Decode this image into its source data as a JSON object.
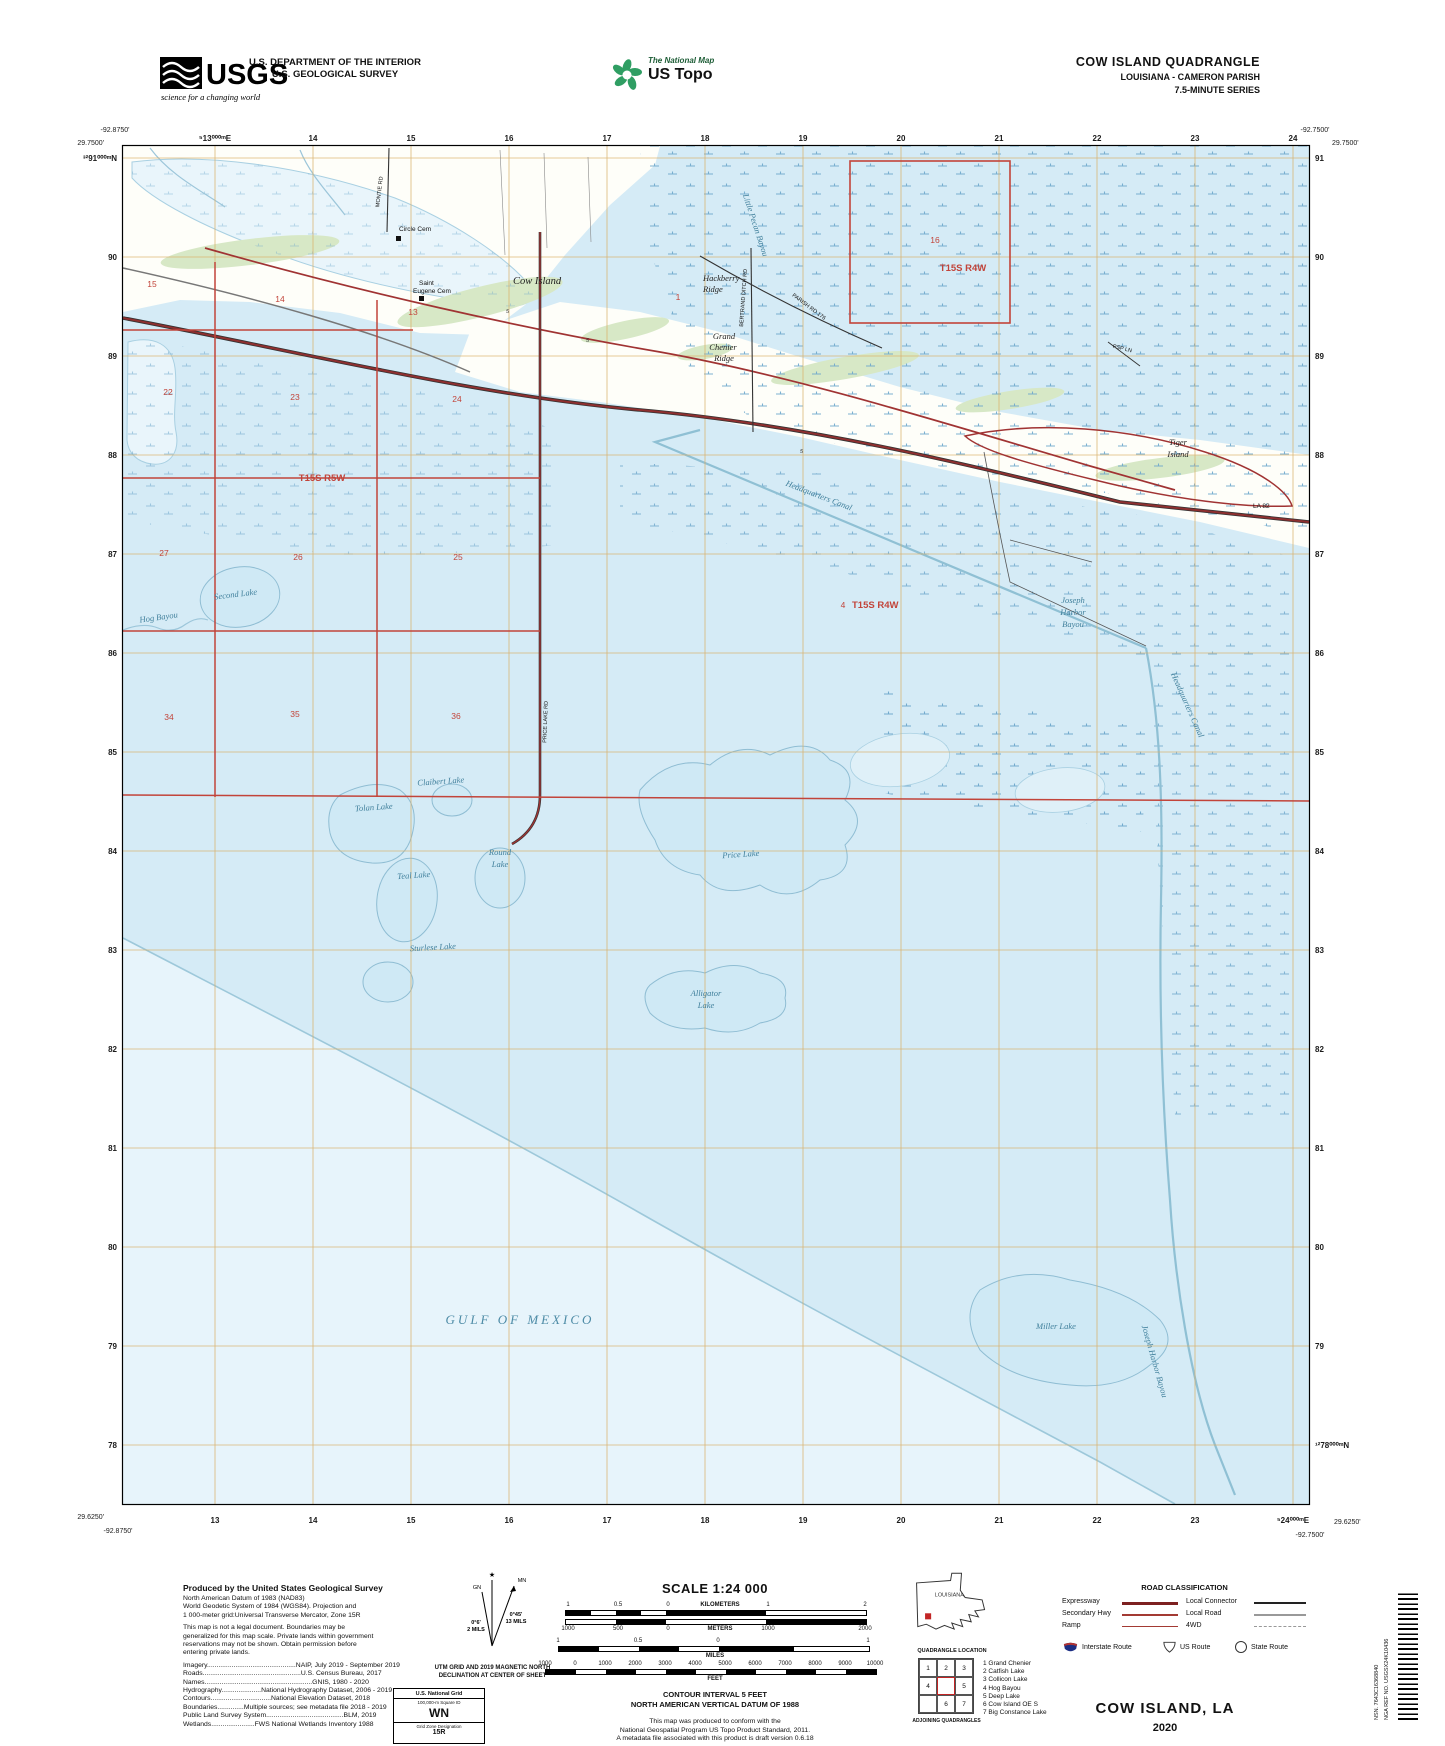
{
  "header": {
    "usgs": "USGS",
    "usgs_tagline": "science for a changing world",
    "dept1": "U.S. DEPARTMENT OF THE INTERIOR",
    "dept2": "U.S. GEOLOGICAL SURVEY",
    "tnm1": "The National Map",
    "tnm2": "US Topo",
    "title": "COW ISLAND QUADRANGLE",
    "subtitle": "LOUISIANA - CAMERON PARISH",
    "series": "7.5-MINUTE SERIES"
  },
  "corners": {
    "tl_lon": "-92.8750'",
    "tl_lat": "29.7500'",
    "tr_lon": "-92.7500'",
    "tr_lat": "29.7500'",
    "bl_lat": "29.6250'",
    "bl_lon": "-92.8750'",
    "br_lat": "29.6250'",
    "br_lon": "-92.7500'"
  },
  "grid": {
    "top": [
      "⁵13⁰⁰⁰ᵐE",
      "14",
      "15",
      "16",
      "17",
      "18",
      "19",
      "20",
      "21",
      "22",
      "23",
      "24"
    ],
    "bottom": [
      "13",
      "14",
      "15",
      "16",
      "17",
      "18",
      "19",
      "20",
      "21",
      "22",
      "23",
      "⁵24⁰⁰⁰ᵐE"
    ],
    "left": [
      "³²91⁰⁰⁰ᵐN",
      "90",
      "89",
      "88",
      "87",
      "86",
      "85",
      "84",
      "83",
      "82",
      "81",
      "80",
      "79",
      "78"
    ],
    "right": [
      "91",
      "90",
      "89",
      "88",
      "87",
      "86",
      "85",
      "84",
      "83",
      "82",
      "81",
      "80",
      "79",
      "¹²78⁰⁰⁰ᵐN"
    ]
  },
  "plss": {
    "sections": [
      "15",
      "14",
      "13",
      "22",
      "23",
      "24",
      "27",
      "26",
      "25",
      "34",
      "35",
      "36",
      "16",
      "1",
      "4"
    ],
    "townships": [
      "T15S R5W",
      "T15S R4W",
      "T15S R4W"
    ]
  },
  "water": [
    "Second Lake",
    "Hog Bayou",
    "Claibert Lake",
    "Tolan Lake",
    "Round",
    "Lake",
    "Teal Lake",
    "Sturlese Lake",
    "Price Lake",
    "Alligator",
    "Lake",
    "Miller Lake",
    "GULF OF MEXICO",
    "Headquarters Canal",
    "Headquarters Canal",
    "Joseph",
    "Harbor",
    "Bayou",
    "Joseph Harbor Bayou",
    "Little Pecan Bayou"
  ],
  "places": [
    "Circle Cem",
    "Saint",
    "Eugene Cem",
    "Cow Island",
    "Hackberry",
    "Ridge",
    "Grand",
    "Chenier",
    "Ridge",
    "Tiger",
    "Island",
    "LA 82"
  ],
  "road_names": [
    "MONTIE RD",
    "PARISH RD 176",
    "BERTRAND DITCH RD",
    "PRICE LAKE RD",
    "PSP LN"
  ],
  "fives": [
    "5",
    "5",
    "5"
  ],
  "footer": {
    "produced": "Produced by the United States Geological Survey",
    "datum": [
      "North American Datum of 1983 (NAD83)",
      "World Geodetic System of 1984 (WGS84).  Projection and",
      "1 000-meter grid:Universal Transverse Mercator, Zone 15R"
    ],
    "legal": [
      "This map is not a legal document. Boundaries may be",
      "generalized for this map scale. Private lands within government",
      "reservations may not be shown. Obtain permission before",
      "entering private lands."
    ],
    "credits": [
      "Imagery...............................................NAIP, July 2019 - September 2019",
      "Roads....................................................U.S. Census Bureau, 2017",
      "Names.........................................................GNIS, 1980 - 2020",
      "Hydrography.....................National Hydrography Dataset, 2006 - 2019",
      "Contours................................National Elevation Dataset, 2018",
      "Boundaries..............Multiple sources; see metadata file 2018 - 2019",
      "Public Land Survey System.........................................BLM, 2019",
      "Wetlands.......................FWS National Wetlands Inventory 1988"
    ],
    "decl": {
      "gn": "GN",
      "mn": "MN",
      "star": "★",
      "left1": "0°6'",
      "left2": "2 MILS",
      "right1": "0°45'",
      "right2": "13 MILS",
      "cap1": "UTM GRID AND 2019 MAGNETIC NORTH",
      "cap2": "DECLINATION AT CENTER OF SHEET"
    },
    "usng": {
      "title": "U.S. National Grid",
      "sub": "100,000-m Square ID",
      "square": "WN",
      "gzd_label": "Grid Zone Designation",
      "gzd": "15R"
    },
    "scale": {
      "title": "SCALE 1:24 000",
      "km": [
        "1",
        "0.5",
        "0",
        "KILOMETERS",
        "1",
        "2"
      ],
      "m": [
        "1000",
        "500",
        "0",
        "METERS",
        "1000",
        "2000"
      ],
      "mi": [
        "1",
        "0.5",
        "0",
        "1"
      ],
      "mi_unit": "MILES",
      "ft": [
        "1000",
        "0",
        "1000",
        "2000",
        "3000",
        "4000",
        "5000",
        "6000",
        "7000",
        "8000",
        "9000",
        "10000"
      ],
      "ft_unit": "FEET",
      "contour1": "CONTOUR INTERVAL 5 FEET",
      "contour2": "NORTH AMERICAN VERTICAL DATUM OF 1988",
      "standard": [
        "This map was produced to conform with the",
        "National Geospatial Program US Topo Product Standard, 2011.",
        "A metadata file associated with this product is draft version 0.6.18"
      ]
    },
    "location": {
      "state": "LOUISIANA",
      "caption": "QUADRANGLE LOCATION"
    },
    "adjoining": {
      "cells": [
        "1",
        "2",
        "3",
        "4",
        "5",
        "6",
        "7"
      ],
      "names": [
        "1 Grand Chenier",
        "2 Catfish Lake",
        "3 Collicon Lake",
        "4 Hog Bayou",
        "5 Deep Lake",
        "6 Cow Island OE S",
        "7 Big Constance Lake"
      ],
      "caption": "ADJOINING QUADRANGLES"
    },
    "roads": {
      "title": "ROAD CLASSIFICATION",
      "left": [
        "Expressway",
        "Secondary Hwy",
        "Ramp"
      ],
      "right": [
        "Local Connector",
        "Local Road",
        "4WD"
      ],
      "shields": [
        "Interstate Route",
        "US Route",
        "State Route"
      ]
    },
    "name": "COW ISLAND,  LA",
    "year": "2020",
    "nsn": "NSN.  7643C16368840",
    "nga": "NGA REF NO.  USGSX24K10436"
  }
}
